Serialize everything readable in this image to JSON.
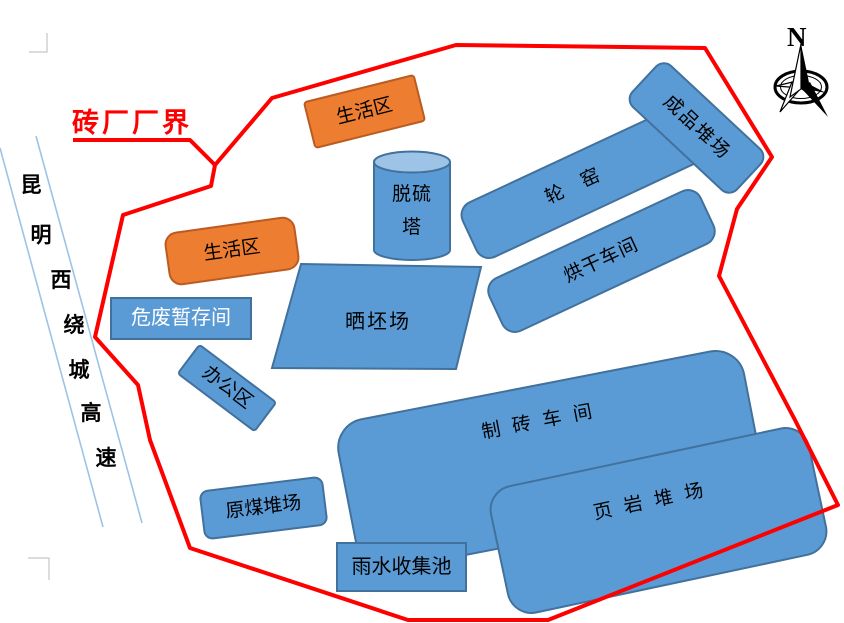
{
  "figure": {
    "type": "site-plan",
    "boundary_label": "砖厂厂界"
  },
  "road": {
    "name": "昆明西绕城高速"
  },
  "compass": {
    "label": "N"
  },
  "zones": {
    "living_top": "生活区",
    "living_left": "生活区",
    "desulfurization_tower": "脱硫塔",
    "ring_kiln": "轮窑",
    "drying_workshop": "烘干车间",
    "finished_product_yard": "成品堆场",
    "hazardous_waste_storage": "危废暂存间",
    "office_area": "办公区",
    "brick_drying_field": "晒坯场",
    "brick_making_workshop": "制砖车间",
    "shale_yard": "页岩堆场",
    "raw_coal_yard": "原煤堆场",
    "rainwater_pool": "雨水收集池"
  },
  "colors": {
    "zone_blue": "#5B9BD5",
    "zone_blue_border": "#41719C",
    "zone_orange": "#ED7D31",
    "zone_orange_border": "#BC5B21",
    "cylinder_top_blue": "#9DC3E6",
    "boundary_red": "#FF0000",
    "road_line_blue": "#9DC3E6",
    "hazardous_text": "#FFFFFF",
    "label_text": "#000000"
  }
}
